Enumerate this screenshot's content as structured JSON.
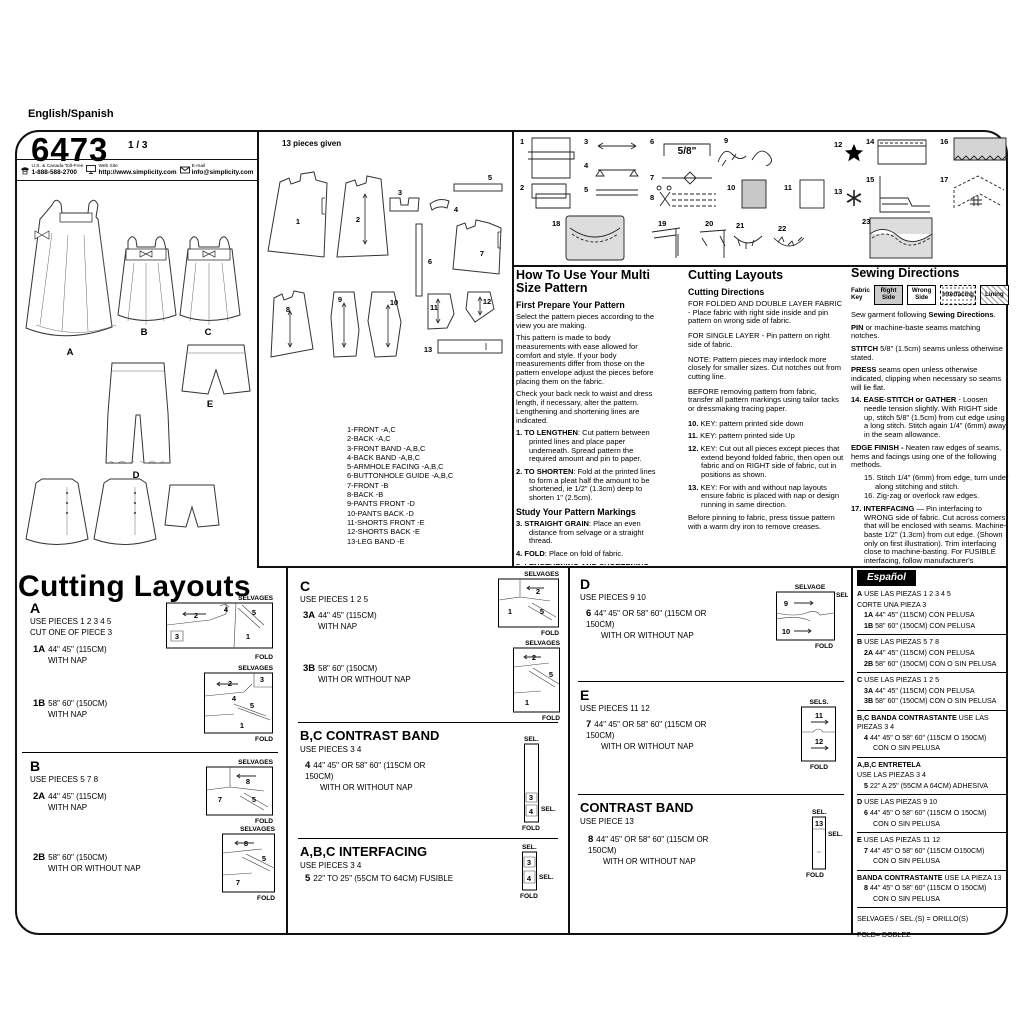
{
  "header": {
    "language": "English/Spanish",
    "pattern_number": "6473",
    "sheet_number": "1 / 3",
    "phone_label": "U.S. & Canada Toll-Free",
    "phone": "1-888-588-2700",
    "web_label": "Web Site",
    "web": "http://www.simplicity.com",
    "email_label": "E-mail",
    "email": "info@simplicity.com"
  },
  "views": {
    "labels": [
      "A",
      "B",
      "C",
      "D",
      "E"
    ]
  },
  "pieces": {
    "title": "13 pieces given",
    "numbers": [
      "1",
      "2",
      "3",
      "4",
      "5",
      "6",
      "7",
      "8",
      "9",
      "10",
      "11",
      "12",
      "13"
    ],
    "list": [
      "1-FRONT -A,C",
      "2-BACK -A,C",
      "3-FRONT BAND -A,B,C",
      "4-BACK BAND -A,B,C",
      "5-ARMHOLE FACING -A,B,C",
      "6-BUTTONHOLE GUIDE -A,B,C",
      "7-FRONT -B",
      "8-BACK -B",
      "9-PANTS FRONT -D",
      "10-PANTS BACK -D",
      "11-SHORTS FRONT -E",
      "12-SHORTS BACK -E",
      "13-LEG BAND -E"
    ]
  },
  "diagrams": {
    "numbers": [
      "1",
      "2",
      "3",
      "4",
      "5",
      "6",
      "7",
      "8",
      "9",
      "10",
      "11",
      "12",
      "13",
      "14",
      "15",
      "16",
      "17",
      "18",
      "19",
      "20",
      "21",
      "22",
      "23"
    ],
    "seam_allowance": "5/8\""
  },
  "howto": {
    "title": "How To Use Your Multi Size Pattern",
    "prep_heading": "First Prepare Your Pattern",
    "p1": "Select the pattern pieces according to the view you are making.",
    "p2": "This pattern is made to body measurements with ease allowed for comfort and style. If your body measurements differ from those on the pattern envelope adjust the pieces before placing them on the fabric.",
    "p3": "Check your back neck to waist and dress length, if necessary, alter the pattern. Lengthening and shortening lines are indicated.",
    "steps": [
      {
        "n": "1.",
        "b": "TO LENGTHEN",
        "t": ": Cut pattern between printed lines and place paper underneath. Spread pattern the required amount and pin to paper."
      },
      {
        "n": "2.",
        "b": "TO SHORTEN",
        "t": ": Fold at the printed lines to form a pleat half the amount to be shortened, ie 1/2\" (1.3cm) deep to shorten 1\" (2.5cm)."
      }
    ],
    "markings_heading": "Study Your Pattern Markings",
    "markings": [
      {
        "n": "3.",
        "b": "STRAIGHT GRAIN",
        "t": ": Place an even distance from selvage or a straight thread."
      },
      {
        "n": "4.",
        "b": "FOLD",
        "t": ": Place on fold of fabric."
      },
      {
        "n": "5.",
        "b": "LENGTHENING AND SHORTENING LINES",
        "t": "."
      },
      {
        "n": "6.",
        "b": "SEAM ALLOWANCE",
        "t": ": 5/8\" (1.5cm) unless otherwise stated."
      },
      {
        "n": "7.",
        "b": "NOTCHES",
        "t": ": Match notches."
      },
      {
        "n": "8.",
        "b": "CUTTING LINES",
        "t": ": Multi patterns have different cutting lines for different sizes."
      },
      {
        "n": "9.",
        "b": "TAILOR-TACKS",
        "t": ": With double thread make two loose stitches forming loop through fabric layers and pattern leaving long ends. Cut loop to remove pattern. Snip thread between fabric layers. Leave tufts."
      }
    ]
  },
  "cutting": {
    "title": "Cutting Layouts",
    "subtitle": "Cutting Directions",
    "p1": "FOR FOLDED AND DOUBLE LAYER FABRIC - Place fabric with right side inside and pin pattern on wrong side of fabric.",
    "p2": "FOR SINGLE LAYER - Pin pattern on right side of fabric.",
    "p3": "NOTE: Pattern pieces may interlock more closely for smaller sizes. Cut notches out from cutting line.",
    "p4": "BEFORE removing pattern from fabric, transfer all pattern markings using tailor tacks or dressmaking tracing paper.",
    "steps": [
      {
        "n": "10.",
        "t": "KEY: pattern printed side down"
      },
      {
        "n": "11.",
        "t": "KEY: pattern printed side Up"
      },
      {
        "n": "12.",
        "t": "KEY: Cut out all pieces except pieces that extend beyond folded fabric, then open out fabric and on RIGHT side of fabric, cut in positions as shown."
      },
      {
        "n": "13.",
        "t": "KEY: For with and without nap layouts ensure fabric is placed with nap or design running in same direction."
      }
    ],
    "p5": "Before pinning to fabric, press tissue pattern with a warm dry iron to remove creases."
  },
  "sewing": {
    "title": "Sewing Directions",
    "fabric_key_label": "Fabric Key",
    "key": [
      "Right Side",
      "Wrong Side",
      "Interfacing",
      "Lining"
    ],
    "p": [
      {
        "n": "",
        "pre": "Sew garment following ",
        "b": "Sewing Directions",
        "t": "."
      },
      {
        "n": "",
        "pre": "",
        "b": "PIN",
        "t": " or machine-baste seams matching notches."
      },
      {
        "n": "",
        "pre": "",
        "b": "STITCH",
        "t": " 5/8\" (1.5cm) seams unless otherwise stated."
      },
      {
        "n": "",
        "pre": "",
        "b": "PRESS",
        "t": " seams open unless otherwise indicated, clipping when necessary so seams will lie flat."
      },
      {
        "n": "14.",
        "pre": "",
        "b": "EASE-STITCH or GATHER",
        "t": " - Loosen needle tension slightly. With RIGHT side up, stitch 5/8\" (1.5cm) from cut edge using a long stitch. Stitch again 1/4\" (6mm) away in the seam allowance."
      },
      {
        "n": "",
        "pre": "",
        "b": "EDGE FINISH -",
        "t": " Neaten raw edges of seams, hems and facings using one of the following methods."
      },
      {
        "n": "15.",
        "pre": "",
        "b": "",
        "t": "Stitch 1/4\" (6mm) from edge, turn under along stitching and stitch."
      },
      {
        "n": "16.",
        "pre": "",
        "b": "",
        "t": "Zig-zag or overlock raw edges."
      },
      {
        "n": "17.",
        "pre": "",
        "b": "INTERFACING",
        "t": " — Pin interfacing to WRONG side of fabric. Cut across corners that will be enclosed with seams. Machine-baste 1/2\" (1.3cm) from cut edge. (Shown only on first illustration). Trim interfacing close to machine-basting. For FUSIBLE interfacing, follow manufacturer's directions."
      },
      {
        "n": "18.",
        "pre": "",
        "b": "STAY-STITCH",
        "t": " —Stitch 1/2\" (1.3cm) from cut edge, in direction of arrows: (Shown only in the first illustration)."
      },
      {
        "n": "",
        "pre": "",
        "b": "LAYERING",
        "t": " — Trim seam allowance in layers."
      },
      {
        "n": "19.",
        "pre": "",
        "b": "",
        "t": "Layer enclosed seams"
      },
      {
        "n": "20.",
        "pre": "",
        "b": "",
        "t": "Trim corners"
      },
      {
        "n": "21.",
        "pre": "",
        "b": "",
        "t": "Clip inner curves"
      },
      {
        "n": "22.",
        "pre": "",
        "b": "",
        "t": "Notch outer curves"
      },
      {
        "n": "23.",
        "pre": "",
        "b": "UNDERSTITCH",
        "t": " —Press facing away from garment; press seam toward facing. Facing side up, understitch close to seam through facing and seam allowances."
      }
    ]
  },
  "layouts": {
    "title": "Cutting Layouts",
    "labels": {
      "selvages": "SELVAGES",
      "selvage": "SELVAGE",
      "sel": "SEL.",
      "sels": "SELS.",
      "fold": "FOLD"
    },
    "a": {
      "letter": "A",
      "use": "USE PIECES  1 2 3 4 5",
      "cut": "CUT ONE OF PIECE 3",
      "e1": {
        "code": "1A",
        "size": "44\" 45\" (115CM)",
        "nap": "WITH NAP"
      },
      "e2": {
        "code": "1B",
        "size": "58\" 60\" (150CM)",
        "nap": "WITH NAP"
      },
      "d1_nums": [
        "2",
        "4",
        "5",
        "3",
        "1"
      ],
      "d2_nums": [
        "2",
        "3",
        "4",
        "5",
        "1"
      ]
    },
    "b": {
      "letter": "B",
      "use": "USE PIECES  5 7 8",
      "e1": {
        "code": "2A",
        "size": "44\" 45\" (115CM)",
        "nap": "WITH NAP"
      },
      "e2": {
        "code": "2B",
        "size": "58\" 60\" (150CM)",
        "nap": "WITH OR WITHOUT NAP"
      },
      "d1_nums": [
        "8",
        "7",
        "5"
      ],
      "d2_nums": [
        "8",
        "5",
        "7"
      ]
    },
    "c": {
      "letter": "C",
      "use": "USE PIECES  1 2 5",
      "e1": {
        "code": "3A",
        "size": "44\" 45\" (115CM)",
        "nap": "WITH NAP"
      },
      "e2": {
        "code": "3B",
        "size": "58\" 60\" (150CM)",
        "nap": "WITH OR WITHOUT NAP"
      },
      "d1_nums": [
        "2",
        "1",
        "5"
      ],
      "d2_nums": [
        "2",
        "5",
        "1"
      ]
    },
    "bc_band": {
      "title": "B,C CONTRAST BAND",
      "use": "USE PIECES  3 4",
      "e1": {
        "code": "4",
        "size": "44\" 45\" OR 58\" 60\" (115CM OR 150CM)",
        "nap": "WITH OR WITHOUT NAP"
      },
      "d_nums": [
        "3",
        "4"
      ]
    },
    "abc_interfacing": {
      "title": "A,B,C INTERFACING",
      "use": "USE PIECES  3 4",
      "e1": {
        "code": "5",
        "size": "22\" TO 25\" (55CM TO 64CM) FUSIBLE",
        "nap": ""
      },
      "d_nums": [
        "3",
        "4"
      ]
    },
    "d": {
      "letter": "D",
      "use": "USE PIECES  9 10",
      "e1": {
        "code": "6",
        "size": "44\" 45\" OR 58\" 60\" (115CM OR 150CM)",
        "nap": "WITH OR WITHOUT NAP"
      },
      "d_nums": [
        "9",
        "10"
      ]
    },
    "e": {
      "letter": "E",
      "use": "USE PIECES  11 12",
      "e1": {
        "code": "7",
        "size": "44\" 45\" OR 58\" 60\" (115CM OR 150CM)",
        "nap": "WITH OR WITHOUT NAP"
      },
      "d_nums": [
        "11",
        "12"
      ]
    },
    "band": {
      "title": "CONTRAST BAND",
      "use": "USE PIECE  13",
      "e1": {
        "code": "8",
        "size": "44\" 45\" OR 58\" 60\" (115CM OR 150CM)",
        "nap": "WITH OR WITHOUT NAP"
      },
      "d_nums": [
        "13"
      ]
    }
  },
  "espanol": {
    "title": "Español",
    "rows": [
      {
        "b": "A",
        "t": "USE LAS PIEZAS 1 2 3 4 5"
      },
      {
        "b": "",
        "t": "CORTE UNA PIEZA 3"
      },
      {
        "b": "1A",
        "t": "44\" 45\" (115CM) CON PELUSA"
      },
      {
        "b": "1B",
        "t": "58\" 60\" (150CM) CON PELUSA"
      },
      {
        "b": "B",
        "t": "USE LAS PIEZAS 5 7 8"
      },
      {
        "b": "2A",
        "t": "44\" 45\" (115CM) CON PELUSA"
      },
      {
        "b": "2B",
        "t": "58\" 60\" (150CM) CON O SIN PELUSA"
      },
      {
        "b": "C",
        "t": "USE LAS PIEZAS 1 2 5"
      },
      {
        "b": "3A",
        "t": "44\" 45\" (115CM) CON PELUSA"
      },
      {
        "b": "3B",
        "t": "58\" 60\" (150CM) CON O SIN PELUSA"
      },
      {
        "b": "B,C BANDA CONTRASTANTE",
        "t": "USE LAS PIEZAS 3 4"
      },
      {
        "b": "4",
        "t": "44\" 45\" O 58\" 60\" (115CM O 150CM)"
      },
      {
        "b": "",
        "t": "CON O SIN PELUSA"
      },
      {
        "b": "A,B,C ENTRETELA",
        "t": ""
      },
      {
        "b": "",
        "t": "USE LAS PIEZAS 3 4"
      },
      {
        "b": "5",
        "t": "22\" A 25\" (55CM A 64CM) ADHESIVA"
      },
      {
        "b": "D",
        "t": "USE LAS PIEZAS 9 10"
      },
      {
        "b": "6",
        "t": "44\" 45\" O 58\" 60\" (115CM O 150CM)"
      },
      {
        "b": "",
        "t": "CON O SIN PELUSA"
      },
      {
        "b": "E",
        "t": "USE LAS PIEZAS 11 12"
      },
      {
        "b": "7",
        "t": "44\" 45\" O 58\" 60\" (115CM O150CM)"
      },
      {
        "b": "",
        "t": "CON O SIN PELUSA"
      },
      {
        "b": "BANDA CONTRASTANTE",
        "t": "USE LA PIEZA 13"
      },
      {
        "b": "8",
        "t": "44\" 45\" O 58\" 60\" (115CM O 150CM)"
      },
      {
        "b": "",
        "t": "CON O SIN PELUSA"
      },
      {
        "b": "",
        "t": "SELVAGES / SEL.(S) = ORILLO(S)"
      },
      {
        "b": "",
        "t": "FOLD= DOBLEZ"
      }
    ]
  }
}
